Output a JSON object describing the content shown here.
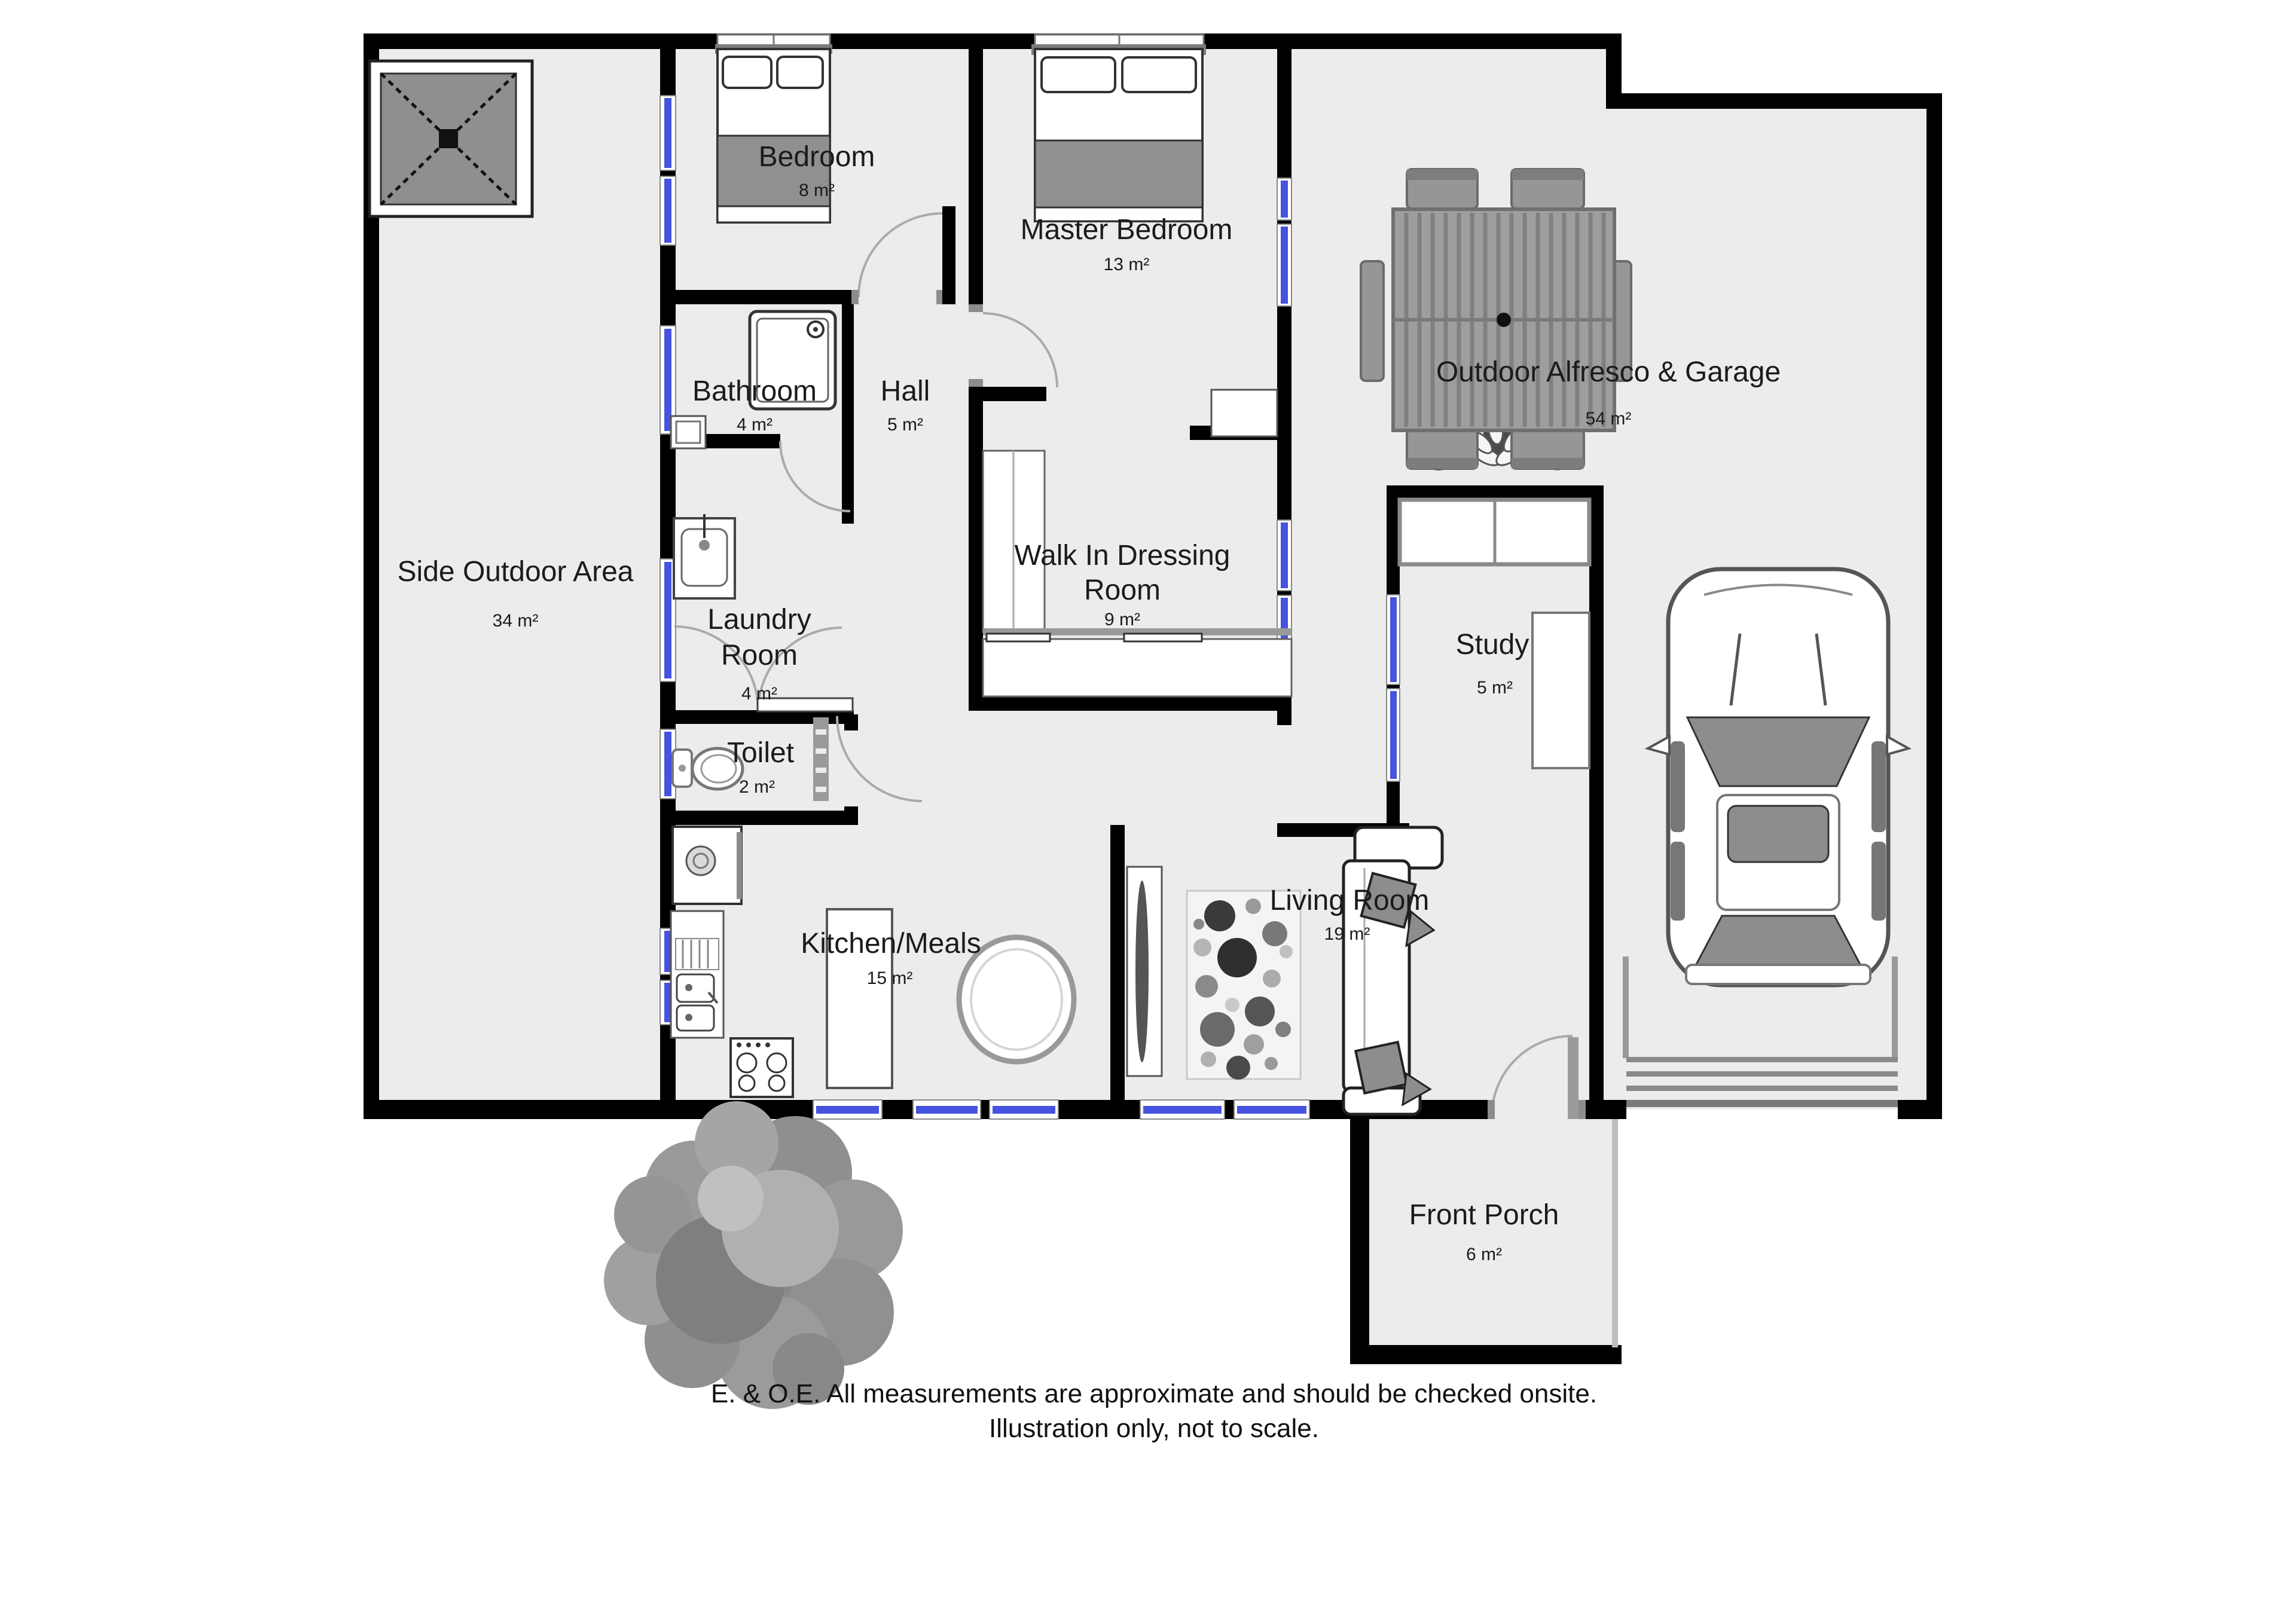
{
  "rooms": [
    {
      "name": "Bedroom",
      "area": "8 m²"
    },
    {
      "name": "Master Bedroom",
      "area": "13 m²"
    },
    {
      "name": "Bathroom",
      "area": "4 m²"
    },
    {
      "name": "Hall",
      "area": "5 m²"
    },
    {
      "name": "Side Outdoor Area",
      "area": "34 m²"
    },
    {
      "name_line1": "Laundry",
      "name_line2": "Room",
      "area": "4 m²"
    },
    {
      "name_line1": "Walk In Dressing",
      "name_line2": "Room",
      "area": "9 m²"
    },
    {
      "name": "Toilet",
      "area": "2 m²"
    },
    {
      "name": "Study",
      "area": "5 m²"
    },
    {
      "name": "Outdoor Alfresco & Garage",
      "area": "54 m²"
    },
    {
      "name": "Kitchen/Meals",
      "area": "15 m²"
    },
    {
      "name": "Living Room",
      "area": "19 m²"
    },
    {
      "name": "Front Porch",
      "area": "6 m²"
    }
  ],
  "footer": {
    "line1": "E. & O.E. All measurements are approximate and should be checked onsite.",
    "line2": "Illustration only, not to scale."
  },
  "colors": {
    "wall": "#000000",
    "floor": "#ececec",
    "window_glass": "#4553e0",
    "furniture_gray": "#8d8d8d",
    "door_arc": "#aaaaaa"
  }
}
